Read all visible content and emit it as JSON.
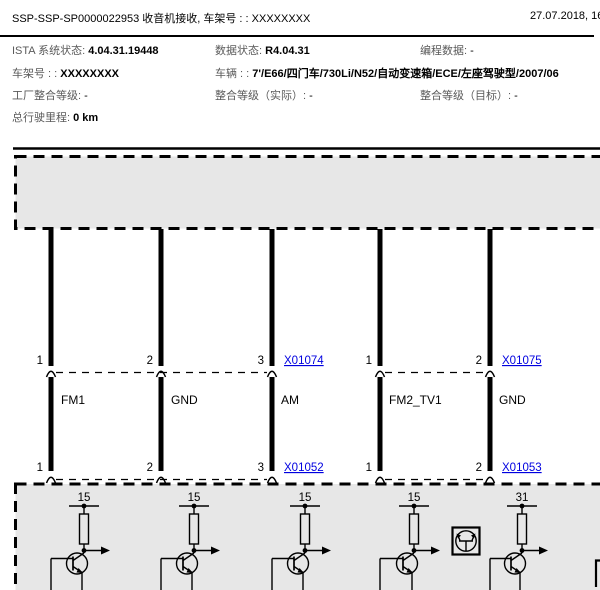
{
  "header": {
    "title": "SSP-SSP-SP0000022953 收音机接收, 车架号 : : XXXXXXXX",
    "datetime": "27.07.2018, 16:3"
  },
  "info": {
    "rows": [
      {
        "cells": [
          {
            "label": "ISTA 系统状态:",
            "value": "4.04.31.19448"
          },
          {
            "label": "数据状态:",
            "value": "R4.04.31"
          },
          {
            "label": "编程数据:",
            "value": "-"
          }
        ]
      },
      {
        "cells": [
          {
            "label": "车架号 : :",
            "value": "XXXXXXXX"
          },
          {
            "label": "车辆 : :",
            "value": "7'/E66/四门车/730Li/N52/自动变速箱/ECE/左座驾驶型/2007/06"
          }
        ]
      },
      {
        "cells": [
          {
            "label": "工厂整合等级:",
            "value": "-"
          },
          {
            "label": "整合等级（实际）:",
            "value": "-"
          },
          {
            "label": "整合等级（目标）:",
            "value": "-"
          }
        ]
      },
      {
        "cells": [
          {
            "label": "总行驶里程:",
            "value": "0 km"
          }
        ]
      }
    ]
  },
  "diagram": {
    "pins_top": [
      "1",
      "2",
      "3",
      "1",
      "2"
    ],
    "pins_bottom": [
      "1",
      "2",
      "3",
      "1",
      "2"
    ],
    "links_top": [
      "X01074",
      "X01075"
    ],
    "links_bottom": [
      "X01052",
      "X01053"
    ],
    "wire_labels": [
      "FM1",
      "GND",
      "AM",
      "FM2_TV1",
      "GND"
    ],
    "terminal_labels": [
      "15",
      "15",
      "15",
      "15",
      "31"
    ],
    "colors": {
      "link": "#0000e0",
      "module_fill": "#e7e7e7",
      "line": "#000000"
    }
  }
}
